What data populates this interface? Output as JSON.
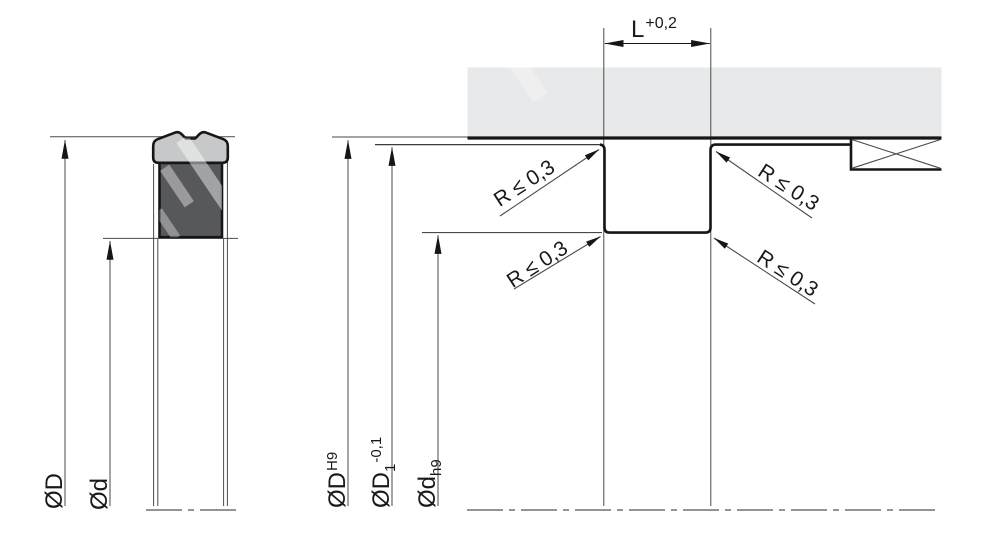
{
  "drawing": {
    "kind": "seal cross-section and groove installation detail",
    "colors": {
      "background": "#ffffff",
      "line_dark": "#161616",
      "line_thin": "#4a4a4a",
      "housing_fill": "#e8e9ea",
      "seal_cap_fill": "#c7c8c9",
      "seal_body_fill": "#57585b",
      "watermark": "rgba(255,255,255,0.45)"
    },
    "left_view": {
      "outer_diameter": "ØD",
      "inner_diameter": "Ød"
    },
    "right_view": {
      "groove_width": "L",
      "groove_width_tolerance": "+0,2",
      "radius_limit_upper_left": "R ≤ 0,3",
      "radius_limit_upper_right": "R ≤ 0,3",
      "radius_limit_lower_left": "R ≤ 0,3",
      "radius_limit_lower_right": "R ≤ 0,3",
      "bore_diameter": "ØD",
      "bore_fit": "H9",
      "clearance_diameter": "ØD",
      "clearance_index": "1",
      "clearance_tolerance": "-0,1",
      "rod_diameter": "Ød",
      "rod_fit": "h9"
    }
  }
}
